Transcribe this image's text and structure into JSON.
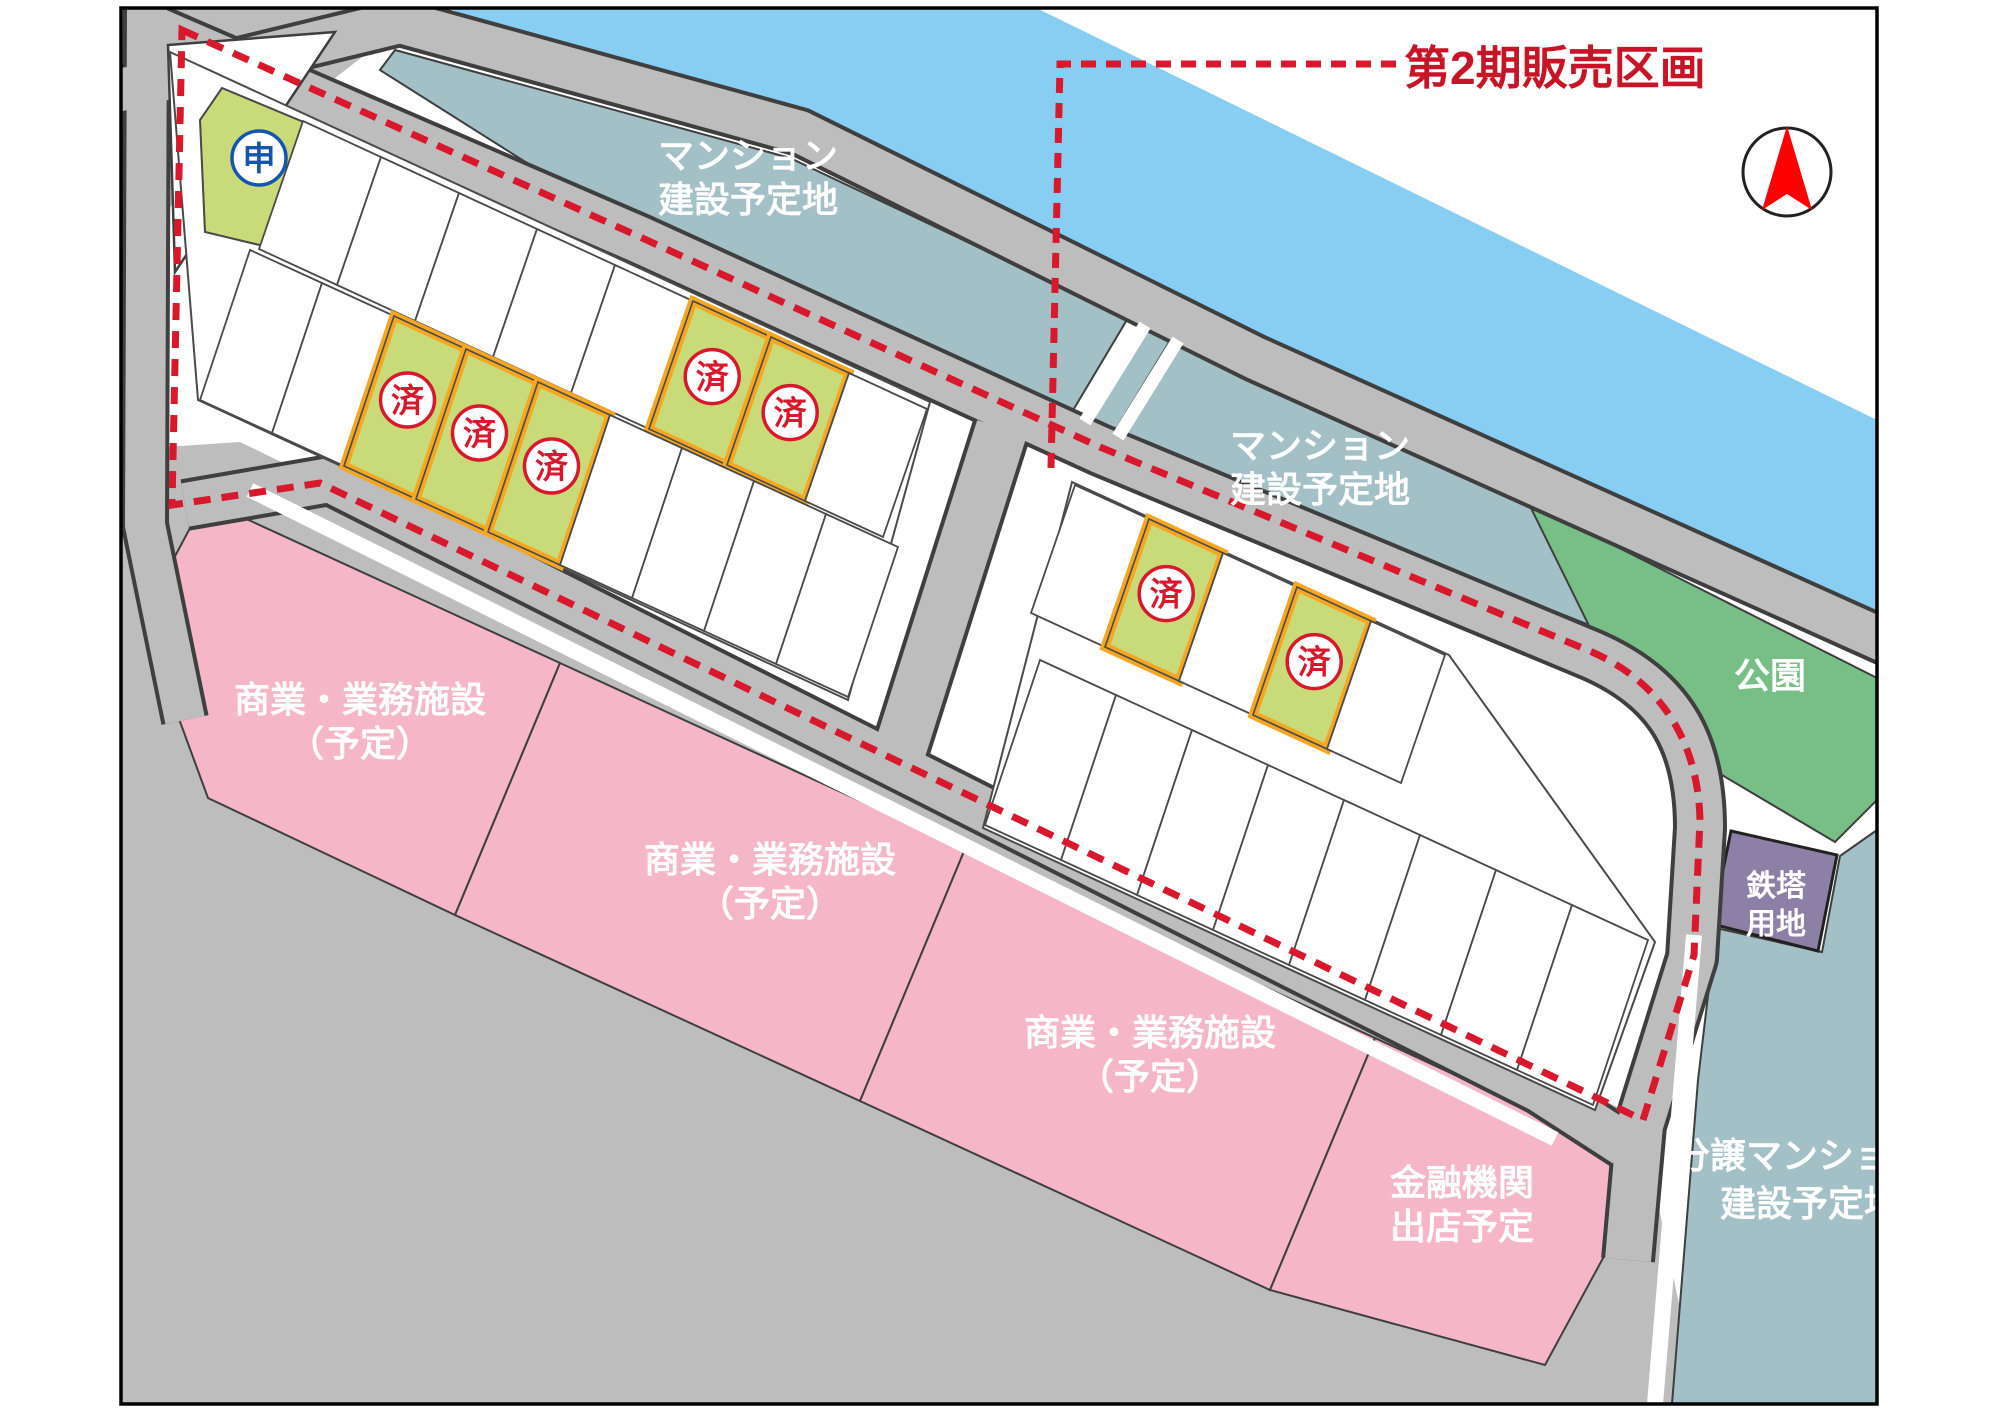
{
  "title": "第2期販売区画 区画図",
  "phase2": {
    "label": "第2期販売区画"
  },
  "badges": {
    "sold": "済",
    "applied": "申"
  },
  "regions": {
    "mansion_upper": {
      "l1": "マンション",
      "l2": "建設予定地"
    },
    "mansion_right": {
      "l1": "マンション",
      "l2": "建設予定地"
    },
    "park": {
      "l1": "公園"
    },
    "tower": {
      "l1": "鉄塔",
      "l2": "用地"
    },
    "bunjo_mansion": {
      "l1": "分譲マンション",
      "l2": "建設予定地"
    },
    "commercial": {
      "l1": "商業・業務施設",
      "l2": "（予定）"
    },
    "financial": {
      "l1": "金融機関",
      "l2": "出店予定"
    }
  },
  "lots": {
    "left_row1": [
      "applied",
      "empty",
      "empty",
      "empty",
      "empty",
      "empty",
      "sold",
      "sold",
      "empty"
    ],
    "left_row2": [
      "empty",
      "empty",
      "sold",
      "sold",
      "sold",
      "empty",
      "empty",
      "empty",
      "empty"
    ],
    "right_row1": [
      "empty",
      "sold",
      "empty",
      "sold",
      "empty"
    ],
    "right_row2": [
      "empty",
      "empty",
      "empty",
      "empty",
      "empty",
      "empty",
      "empty",
      "empty"
    ]
  },
  "colors": {
    "river": "#87CEF2",
    "teal_area": "#A2C0C6",
    "park_green": "#77BF87",
    "tower_purple": "#8C80A7",
    "pink_area": "#F5B6C8",
    "road_gray": "#BDBDBD",
    "road_edge": "#3F3F3F",
    "lot_green": "#C9DB79",
    "lot_orange": "#F5A623",
    "boundary_red": "#D7182D",
    "applied_blue": "#1455AE"
  }
}
